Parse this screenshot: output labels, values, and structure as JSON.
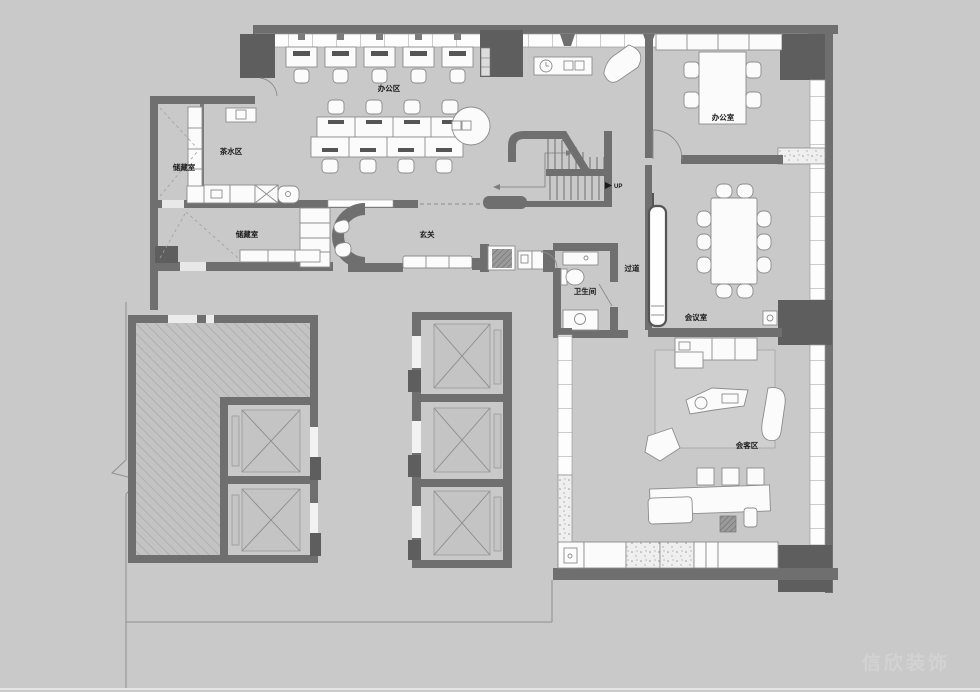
{
  "meta": {
    "type": "architectural-floor-plan"
  },
  "labels": {
    "office_area": "办公区",
    "tea_area": "茶水区",
    "storage_room_1": "储藏室",
    "storage_room_2": "储藏室",
    "entry_hall": "玄关",
    "bathroom": "卫生间",
    "corridor": "过道",
    "private_office": "办公室",
    "meeting_room": "会议室",
    "reception_area": "会客区",
    "stair_direction": "UP"
  },
  "watermark": {
    "text": "信欣装饰"
  },
  "colors": {
    "background": "#c9c9c9",
    "wall": "#6f6f6f",
    "column": "#5e5e5e",
    "furniture_fill": "#fbfbfb",
    "furniture_stroke": "#8c8c8c",
    "label_text": "#1b1b1b",
    "watermark_text": "#d4d4d4",
    "rug": "#cfcfcf",
    "hatch_line": "#a6a6a6"
  }
}
